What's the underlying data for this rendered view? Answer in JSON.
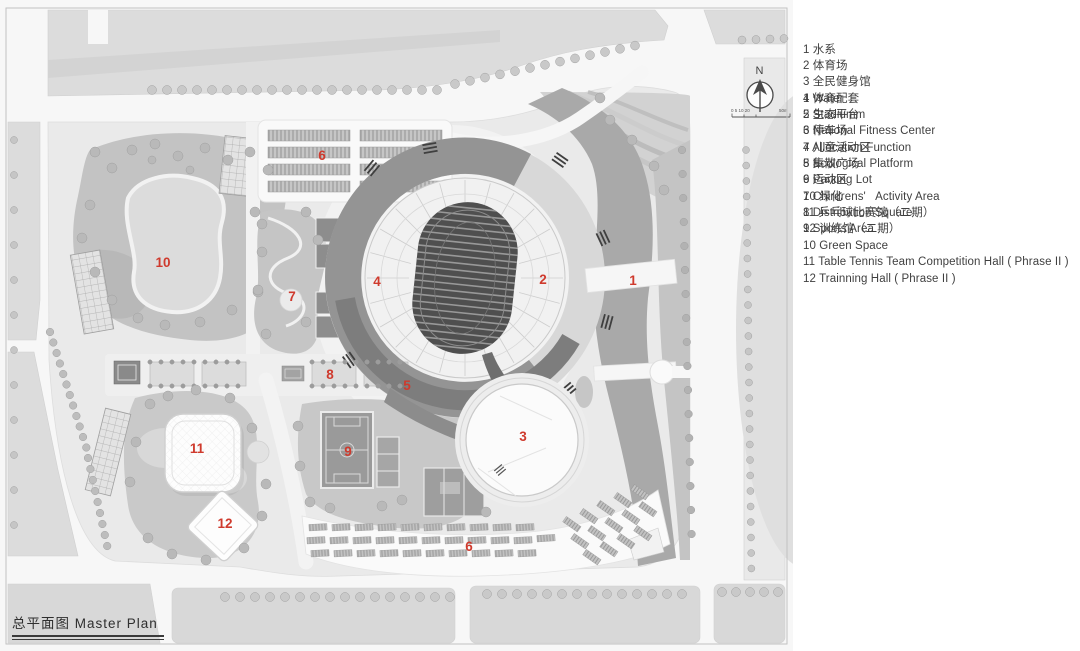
{
  "plan": {
    "title": "总平面图 Master  Plan",
    "north_label": "N",
    "scale_ticks": "0 5 10 20",
    "scale_end": "50m",
    "marker_color": "#cf3a2d",
    "markers": [
      {
        "label": "10",
        "x": 163,
        "y": 267
      },
      {
        "label": "6",
        "x": 322,
        "y": 160
      },
      {
        "label": "7",
        "x": 292,
        "y": 301
      },
      {
        "label": "4",
        "x": 377,
        "y": 286
      },
      {
        "label": "2",
        "x": 543,
        "y": 284
      },
      {
        "label": "1",
        "x": 633,
        "y": 285
      },
      {
        "label": "8",
        "x": 330,
        "y": 379
      },
      {
        "label": "5",
        "x": 407,
        "y": 390
      },
      {
        "label": "9",
        "x": 348,
        "y": 456
      },
      {
        "label": "3",
        "x": 523,
        "y": 441
      },
      {
        "label": "11",
        "x": 197,
        "y": 453
      },
      {
        "label": "12",
        "x": 225,
        "y": 528
      },
      {
        "label": "6",
        "x": 469,
        "y": 551
      }
    ]
  },
  "legend": {
    "zh_items": [
      "1 水系",
      "2 体育场",
      "3 全民健身馆",
      "4 体育配套",
      "5 生态平台",
      "6 停车场",
      "7 儿童活动区",
      "8 集散广场",
      "9 运动区",
      "10 绿化",
      "11 乒乓球比赛馆（二期）",
      "12 训练馆（二期）"
    ],
    "en_items": [
      "1 Water",
      "2 Stadiumm",
      "3 National Fitness Center",
      "4 Allocation Function",
      "5 Ecological Platform",
      "6 Parking Lot",
      "7 Chirdrens'   Activity Area",
      "8 Distribution Square",
      "9 Sports Area",
      "10 Green Space",
      "11 Table Tennis Team Competition Hall ( Phrase II )",
      "12 Trainning Hall ( Phrase II )"
    ]
  }
}
